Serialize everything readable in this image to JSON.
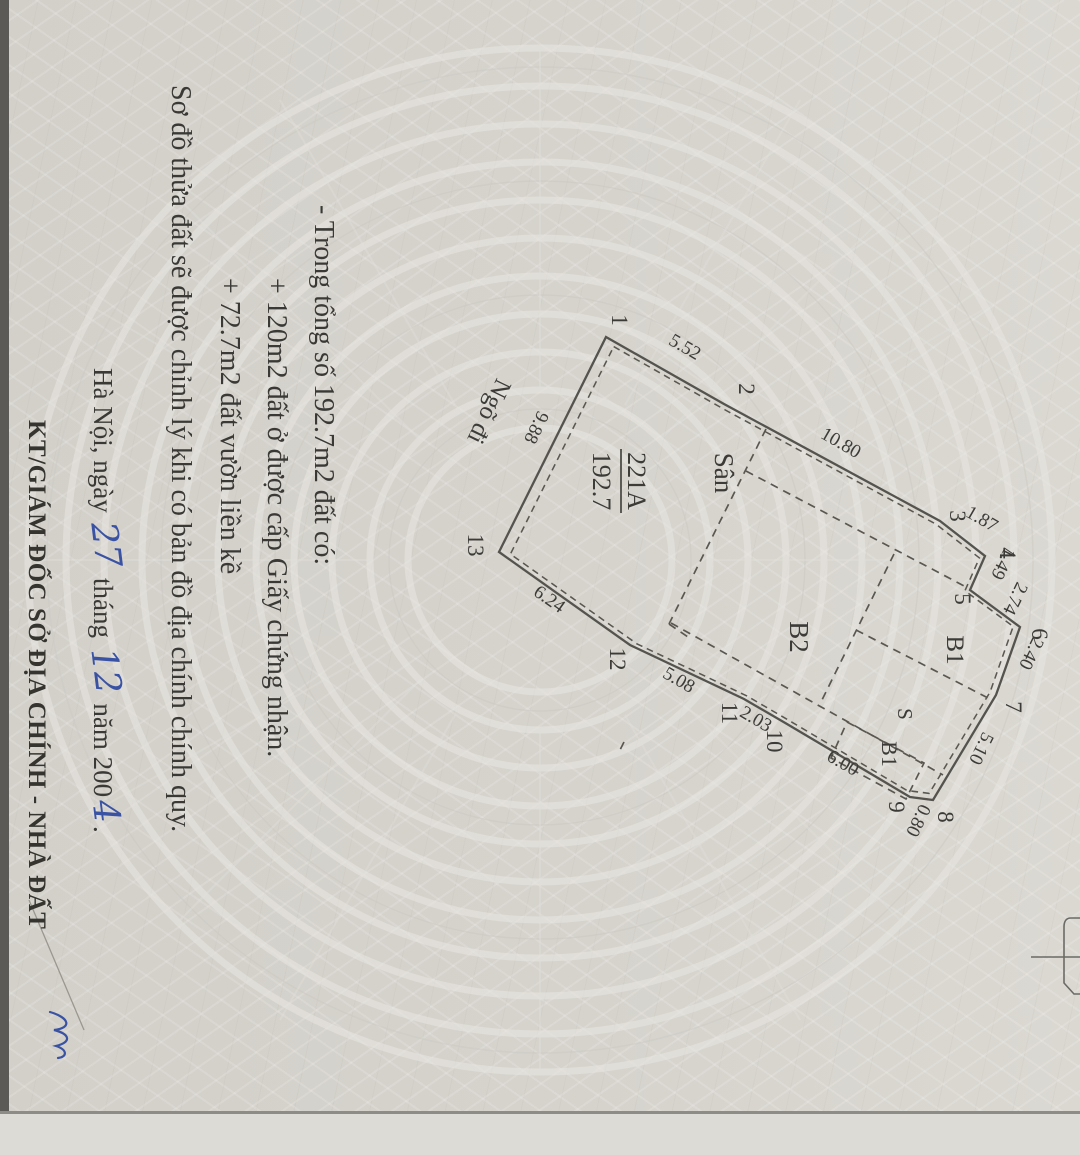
{
  "palette": {
    "paper": "#d6d3cd",
    "ink": "#3a3935",
    "boundary_line": "#55534e",
    "handwriting_blue": "#3952a3"
  },
  "notes": {
    "line1": "- Trong tổng số 192.7m2 đất có:",
    "line2": "+ 120m2 đất ở được cấp Giấy chứng nhận.",
    "line3": "+ 72.7m2 đất vườn liền kề"
  },
  "footer_note": "Sơ đồ thửa đất sẽ được chỉnh lý khi có bản đồ địa chính chính quy.",
  "signature": {
    "place_prefix": "Hà Nội, ngày",
    "day": "27",
    "month_word": "tháng",
    "month": "12",
    "year_prefix": "năm 200",
    "year_digit": "4",
    "period": ".",
    "signer_title": "KT/GIÁM ĐỐC SỞ ĐỊA CHÍNH - NHÀ ĐẤT"
  },
  "diagram": {
    "parcel_id": "221A",
    "parcel_area": "192.7",
    "labels": {
      "san": "Sân",
      "b2": "B2",
      "b1": "B1",
      "s": "S",
      "b1_small": "B1",
      "alley": "Ngõ đi"
    },
    "vertices": [
      "1",
      "2",
      "3",
      "4",
      "5",
      "6",
      "7",
      "8",
      "9",
      "10",
      "11",
      "12",
      "13"
    ],
    "edges": [
      "5.52",
      "10.80",
      "1.87",
      "1.49",
      "2.74",
      "2.40",
      "5.10",
      "0.80",
      "6.00",
      "2.03",
      "5.08",
      "6.24",
      "9.88"
    ]
  }
}
